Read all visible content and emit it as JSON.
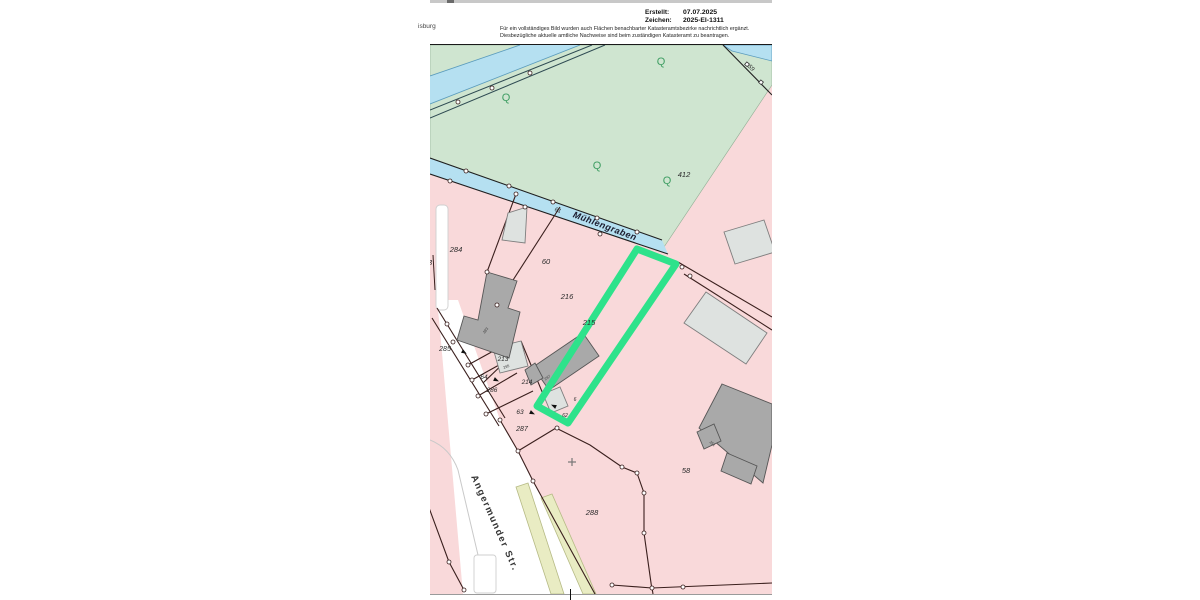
{
  "page": {
    "top_left_text": "isburg",
    "header": {
      "created_label": "Erstellt:",
      "created_value": "07.07.2025",
      "ref_label": "Zeichen:",
      "ref_value": "2025-EI-1311",
      "disclaimer_line1": "Für ein vollständiges Bild wurden auch Flächen benachbarter Katasteramtsbezirke nachrichtlich ergänzt.",
      "disclaimer_line2": "Diesbezügliche aktuelle amtliche Nachweise sind beim zuständigen Katasteramt zu beantragen."
    }
  },
  "map": {
    "stream_name": "Mühlengraben",
    "street_name": "Angermunder Str.",
    "vegetation_symbol": "Q",
    "parcel_labels": [
      "284",
      "33",
      "60",
      "216",
      "215",
      "213",
      "214",
      "285",
      "64",
      "286",
      "63",
      "287",
      "288",
      "58",
      "412",
      "59",
      "61",
      "6",
      "62"
    ],
    "house_numbers": [
      "283",
      "287",
      "295",
      "251"
    ],
    "colors": {
      "parcel_fill": "#f9d9da",
      "vegetation_fill": "#cfe5d0",
      "water_fill": "#b5e0f1",
      "highlight": "#2ee28b",
      "boundary": "#3a1f1d",
      "building_dark": "#a9a9a9",
      "building_light": "#dee2e0",
      "verge_fill": "#e9ecc3"
    }
  }
}
